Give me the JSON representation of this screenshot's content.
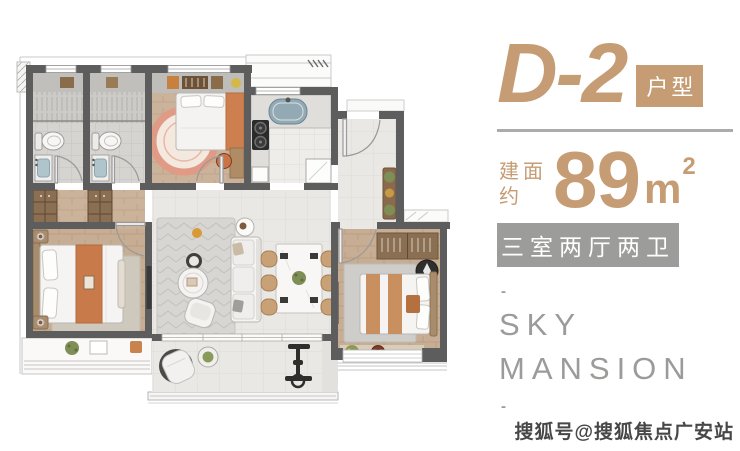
{
  "panel": {
    "unit_name": "D-2",
    "unit_tag": "户型",
    "area_label_1": "建面",
    "area_label_2": "约",
    "area_value": "89",
    "area_unit": "m",
    "area_exponent": "2",
    "layout_badge": "三室两厅两卫",
    "brand_top_dash": "-",
    "brand_line1": "SKY",
    "brand_line2": "MANSION",
    "brand_bottom_dash": "-"
  },
  "watermark": {
    "text": "搜狐号@搜狐焦点广安站"
  },
  "colors": {
    "accent_tan": "#C59C73",
    "badge_gray": "#9C9C9B",
    "brand_gray": "#9B9B9A",
    "wall_gray": "#5D5D5D",
    "wood_floor": "#CBB29A",
    "orange_textile": "#CD7F4F",
    "tile_floor": "#EAE8E5",
    "coral_rug": "#E09A86"
  },
  "floorplan": {
    "rooms": [
      "bathroom-1",
      "bathroom-2",
      "bedroom-2",
      "kitchen",
      "entry-foyer",
      "living-dining",
      "master-bedroom",
      "bedroom-3",
      "balcony",
      "bay-windows"
    ]
  }
}
